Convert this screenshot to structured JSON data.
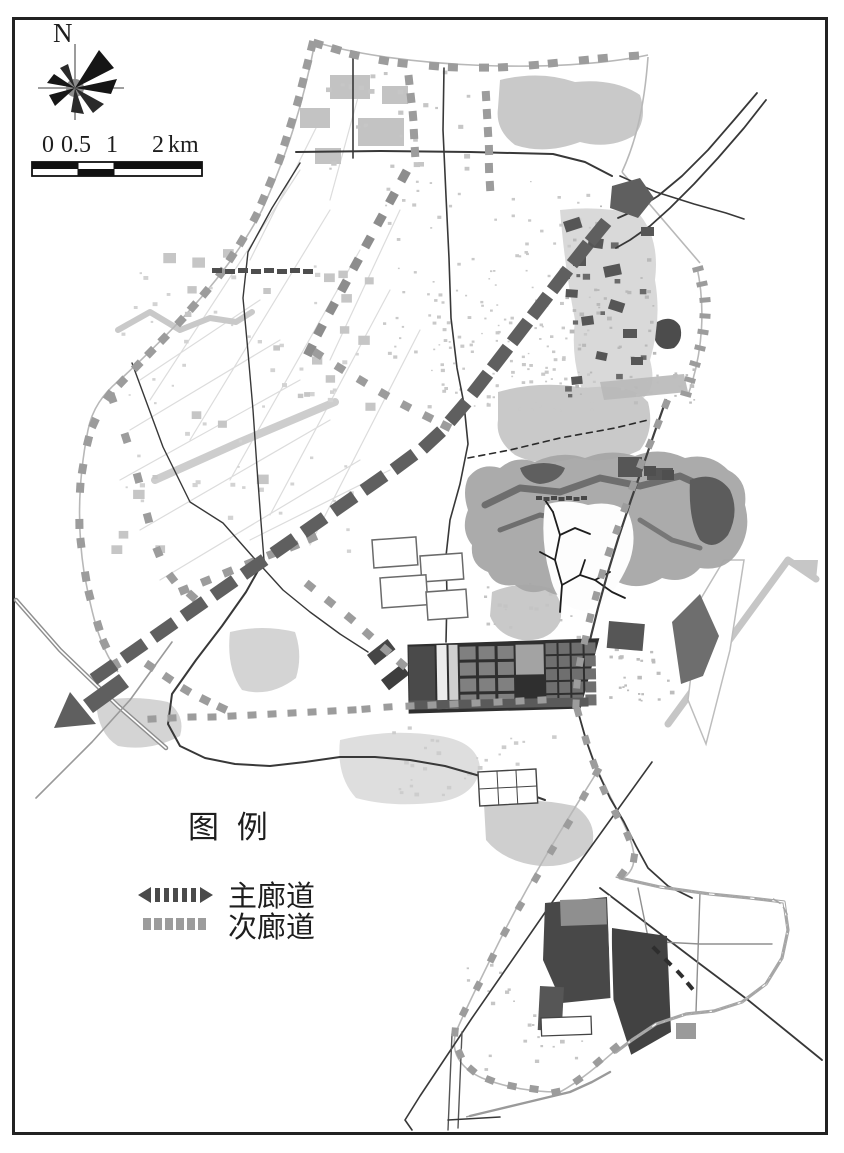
{
  "compass": {
    "north_label": "N"
  },
  "scale_bar": {
    "labels": [
      "0",
      "0.5",
      "1",
      "2"
    ],
    "unit": "km"
  },
  "legend": {
    "title": "图 例",
    "items": [
      {
        "id": "main-corridor",
        "label": "主廊道"
      },
      {
        "id": "secondary-corridor",
        "label": "次廊道"
      }
    ]
  },
  "colors": {
    "frame": "#222222",
    "main_corridor": "#5f5f5f",
    "secondary_corridor": "#9c9c9c",
    "boundary_line": "#b8b8b8",
    "road": "#383838",
    "urban_light": "#c9c9c9",
    "urban_medium": "#8a8a8a",
    "urban_dark": "#4a4a4a",
    "mountain": "#a6a6a6",
    "text": "#1e1e1e"
  }
}
